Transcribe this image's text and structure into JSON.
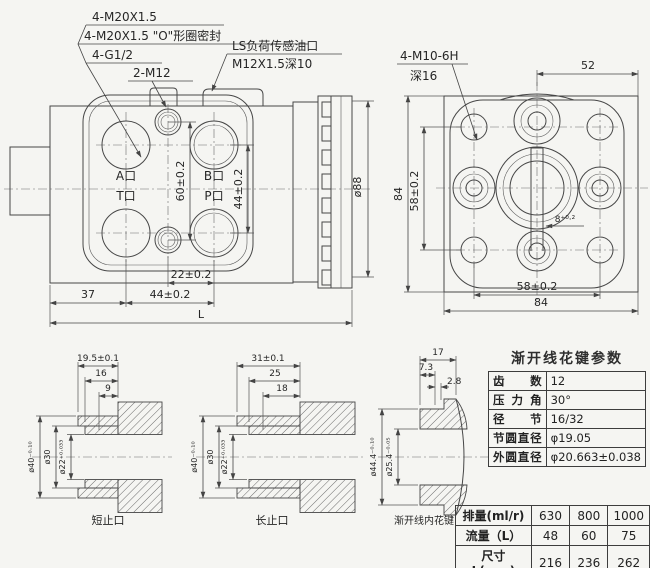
{
  "callouts": {
    "m20": "4-M20X1.5",
    "m20_oring": "4-M20X1.5 \"O\"形圈密封",
    "g12": "4-G1/2",
    "m12": "2-M12",
    "ls_line1": "LS负荷传感油口",
    "ls_line2": "M12X1.5深10",
    "m10_line1": "4-M10-6H",
    "m10_line2": "深16"
  },
  "front_view": {
    "port_a": "A口",
    "port_b": "B口",
    "port_t": "T口",
    "port_p": "P口",
    "dim_60": "60±0.2",
    "dim_44v": "44±0.2",
    "dim_od": "ø88",
    "dim_22": "22±0.2",
    "dim_37": "37",
    "dim_44h": "44±0.2",
    "dim_L": "L"
  },
  "rear_view": {
    "dim_52": "52",
    "dim_84_left": "84",
    "dim_58_left": "58±0.2",
    "dim_slot": "8⁺⁰·²",
    "dim_58_bottom": "58±0.2",
    "dim_84_bottom": "84"
  },
  "sections": {
    "s1": {
      "dim1": "19.5±0.1",
      "dim2": "16",
      "dim3": "9",
      "d40": "ø40⁻⁰·¹⁰",
      "d30": "ø30",
      "d22": "ø22⁺⁰·⁰³³",
      "caption": "短止口"
    },
    "s2": {
      "dim1": "31±0.1",
      "dim2": "25",
      "dim3": "18",
      "d40": "ø40⁻⁰·¹⁰",
      "d30": "ø30",
      "d22": "ø22⁺⁰·⁰³³",
      "caption": "长止口"
    },
    "s3": {
      "dim1": "17",
      "dim2": "7.3",
      "dim3": "2.8",
      "d444": "ø44.4⁻⁰·¹⁰",
      "d254": "ø25.4⁻⁰·⁰⁵",
      "caption": "渐开线内花键"
    }
  },
  "spline_table": {
    "title": "渐开线花键参数",
    "rows": [
      {
        "label": "齿数",
        "value": "12"
      },
      {
        "label": "压力角",
        "value": "30°"
      },
      {
        "label": "径节",
        "value": "16/32"
      },
      {
        "label": "节圆直径",
        "value": "φ19.05"
      },
      {
        "label": "外圆直径",
        "value": "φ20.663±0.038"
      }
    ]
  },
  "size_table": {
    "rows": [
      {
        "label": "排量(ml/r)",
        "v1": "630",
        "v2": "800",
        "v3": "1000"
      },
      {
        "label": "流量（L）",
        "v1": "48",
        "v2": "60",
        "v3": "75"
      },
      {
        "label": "尺寸L(mm)",
        "v1": "216",
        "v2": "236",
        "v3": "262"
      }
    ]
  }
}
